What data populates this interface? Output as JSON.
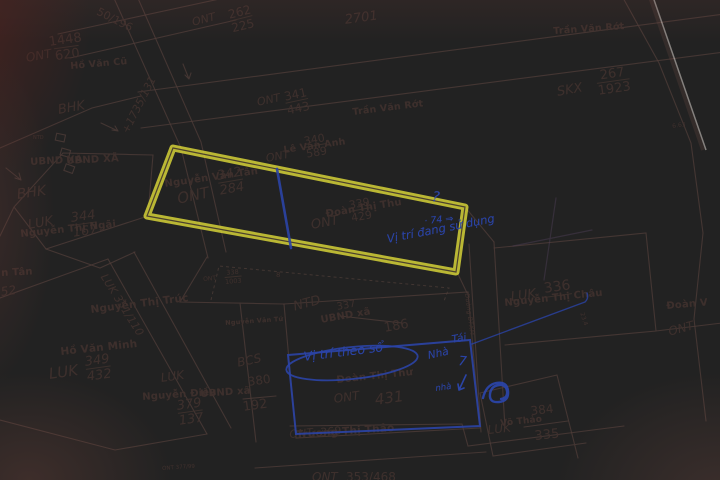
{
  "codes": {
    "ont": "ONT",
    "luk": "LUK",
    "bhk": "BHK",
    "bcs": "BCS",
    "skx": "SKX",
    "ntd": "NTD"
  },
  "parcels": {
    "p196": "50/196",
    "p2701": "2701",
    "p262": {
      "num": "262",
      "den": "225"
    },
    "p1448": {
      "num": "1448",
      "den": "620"
    },
    "p341": {
      "num": "341",
      "den": "443"
    },
    "p267": {
      "num": "267",
      "den": "1923"
    },
    "p342": {
      "num": "342",
      "den": "284"
    },
    "p340": {
      "num": "340",
      "den": "589"
    },
    "p339": {
      "num": "339",
      "den": "429"
    },
    "p338": {
      "num": "338",
      "den": "1003"
    },
    "p344": {
      "num": "344",
      "den": "167"
    },
    "p349": {
      "num": "349",
      "den": "432"
    },
    "p379": {
      "num": "379",
      "den": "137"
    },
    "p380_num": "380",
    "p380_den": "192",
    "p337_num": "337",
    "p337_den": "186",
    "p336": "336",
    "p431": "431",
    "p369": "369",
    "p384": {
      "num": "384",
      "den": "335"
    },
    "p353": "353/468",
    "p377": "ONT 377/99",
    "road1735": "+1735/131",
    "road351": "LUK 351/110",
    "m663": "6.63",
    "m234": "23.4",
    "m8": "8"
  },
  "names": {
    "ho_van_cu": "Hồ Văn Cũ",
    "tran_van_rot": "Trần Văn Rớt",
    "le_van_anh": "Lê Văn Anh",
    "nguyen_van_tan": "Nguyễn Văn Tân",
    "doan_thi_thu": "Đoàn Thị Thu",
    "doan_thi_thu2": "Đoàn Thị Thư",
    "nguyen_thi_ngai": "Nguyễn Thị Ngãi",
    "frag_tan": "n Tân",
    "frag_52": "52",
    "nguyen_thi_truc": "Nguyễn Thị Trúc",
    "ho_van_minh": "Hồ Văn Minh",
    "nguyen_dieu": "Nguyễn Điều",
    "nguyen_van_tu": "Nguyễn Văn Tứ",
    "nguyen_thi_chau": "Nguyễn Thị Châu",
    "doan_v": "Đoàn V",
    "truong_thi_thao": "Trương Thị Thảo",
    "vo_thao": "Võ Thảo",
    "frag_van_co": "Văn Cố"
  },
  "admin": {
    "ubnd_xa": "UBND XÃ",
    "ubnd_xa_lower": "UBND xã",
    "duong_btxm": "Đường BTXM"
  },
  "handwriting": {
    "vi_tri_dang_su_dung": "Vị trí đang sử dụng",
    "vi_tri_theo_so": "Vị trí theo sổ",
    "so_74": "· 74 ⇒",
    "question": "?",
    "tai": "Tái",
    "nha": "Nhà",
    "so_7": "7",
    "nha_nho": "nhà"
  },
  "colors": {
    "paper": "#e9d5d0",
    "ink": "#40322e",
    "highlighter": "#e6e13a",
    "pen": "#2b44a6"
  }
}
